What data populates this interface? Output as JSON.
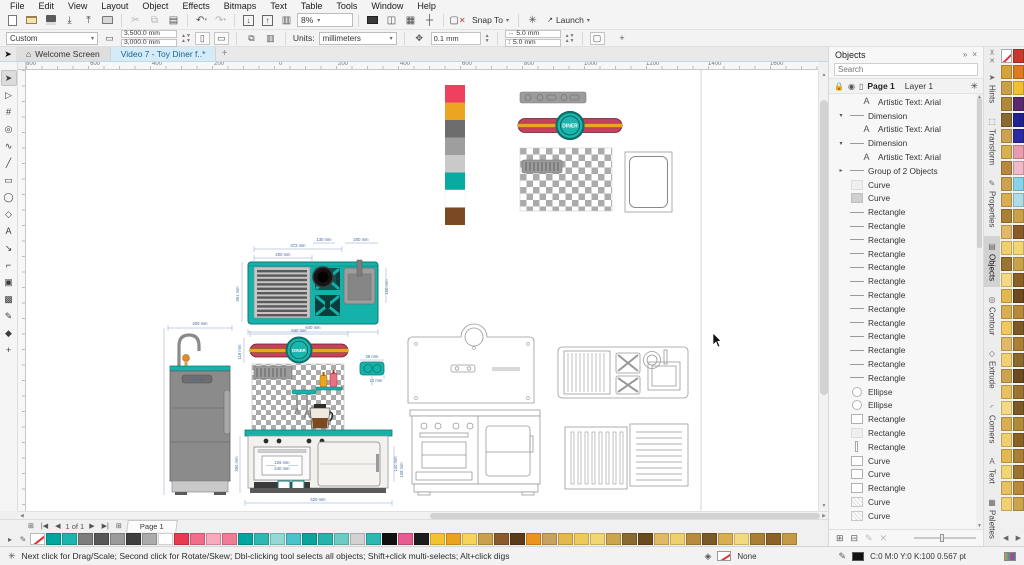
{
  "menu_items": [
    "File",
    "Edit",
    "View",
    "Layout",
    "Object",
    "Effects",
    "Bitmaps",
    "Text",
    "Table",
    "Tools",
    "Window",
    "Help"
  ],
  "toolbar": {
    "zoom": "8%",
    "snap": "Snap To",
    "launch": "Launch"
  },
  "property_bar": {
    "preset": "Custom",
    "width": "3,500.0 mm",
    "height": "3,000.0 mm",
    "units_label": "Units:",
    "units": "millimeters",
    "nudge": "0.1 mm",
    "dup_x": "5.0 mm",
    "dup_y": "5.0 mm"
  },
  "doc_tabs": {
    "welcome": "Welcome Screen",
    "active": "Video 7 - Toy Diner f..*"
  },
  "ruler_numbers": [
    "800",
    "600",
    "400",
    "200",
    "0",
    "200",
    "400",
    "600",
    "800",
    "1000",
    "1200",
    "1400",
    "1600"
  ],
  "toolbox": [
    {
      "g": "➤",
      "cls": "active",
      "name": "pick-tool"
    },
    {
      "g": "▷",
      "cls": "",
      "name": "shape-tool"
    },
    {
      "g": "#",
      "cls": "",
      "name": "crop-tool"
    },
    {
      "g": "◎",
      "cls": "",
      "name": "zoom-tool"
    },
    {
      "g": "∿",
      "cls": "",
      "name": "freehand-tool"
    },
    {
      "g": "╱",
      "cls": "",
      "name": "two-point-line-tool"
    },
    {
      "g": "▭",
      "cls": "",
      "name": "rectangle-tool"
    },
    {
      "g": "◯",
      "cls": "",
      "name": "ellipse-tool"
    },
    {
      "g": "◇",
      "cls": "",
      "name": "polygon-tool"
    },
    {
      "g": "A",
      "cls": "",
      "name": "text-tool"
    },
    {
      "g": "↘",
      "cls": "",
      "name": "dimension-tool"
    },
    {
      "g": "⌐",
      "cls": "",
      "name": "connector-tool"
    },
    {
      "g": "▣",
      "cls": "",
      "name": "drop-shadow-tool"
    },
    {
      "g": "▩",
      "cls": "",
      "name": "transparency-tool"
    },
    {
      "g": "✎",
      "cls": "",
      "name": "eyedropper-tool"
    },
    {
      "g": "◆",
      "cls": "",
      "name": "interactive-fill-tool"
    },
    {
      "g": "+",
      "cls": "",
      "name": "more-tools-button"
    }
  ],
  "objects": {
    "title": "Objects",
    "search_placeholder": "Search",
    "page": "Page 1",
    "layer": "Layer 1",
    "items": [
      {
        "e": "",
        "t": "t-a",
        "cls": "ind1",
        "label": "Artistic Text: Arial"
      },
      {
        "e": "▾",
        "t": "t-line",
        "cls": "",
        "label": "Dimension"
      },
      {
        "e": "",
        "t": "t-a",
        "cls": "ind1",
        "label": "Artistic Text: Arial"
      },
      {
        "e": "▾",
        "t": "t-line",
        "cls": "",
        "label": "Dimension"
      },
      {
        "e": "",
        "t": "t-a",
        "cls": "ind1",
        "label": "Artistic Text: Arial"
      },
      {
        "e": "▸",
        "t": "t-line",
        "cls": "",
        "label": "Group of 2 Objects"
      },
      {
        "e": "",
        "t": "t-sqlight",
        "cls": "",
        "label": "Curve"
      },
      {
        "e": "",
        "t": "t-sqgray",
        "cls": "",
        "label": "Curve"
      },
      {
        "e": "",
        "t": "t-line",
        "cls": "",
        "label": "Rectangle"
      },
      {
        "e": "",
        "t": "t-line",
        "cls": "",
        "label": "Rectangle"
      },
      {
        "e": "",
        "t": "t-line",
        "cls": "",
        "label": "Rectangle"
      },
      {
        "e": "",
        "t": "t-line",
        "cls": "",
        "label": "Rectangle"
      },
      {
        "e": "",
        "t": "t-line",
        "cls": "",
        "label": "Rectangle"
      },
      {
        "e": "",
        "t": "t-line",
        "cls": "",
        "label": "Rectangle"
      },
      {
        "e": "",
        "t": "t-line",
        "cls": "",
        "label": "Rectangle"
      },
      {
        "e": "",
        "t": "t-line",
        "cls": "",
        "label": "Rectangle"
      },
      {
        "e": "",
        "t": "t-line",
        "cls": "",
        "label": "Rectangle"
      },
      {
        "e": "",
        "t": "t-line",
        "cls": "",
        "label": "Rectangle"
      },
      {
        "e": "",
        "t": "t-line",
        "cls": "",
        "label": "Rectangle"
      },
      {
        "e": "",
        "t": "t-line",
        "cls": "",
        "label": "Rectangle"
      },
      {
        "e": "",
        "t": "t-line",
        "cls": "",
        "label": "Rectangle"
      },
      {
        "e": "",
        "t": "t-circle",
        "cls": "",
        "label": "Ellipse"
      },
      {
        "e": "",
        "t": "t-circle",
        "cls": "",
        "label": "Ellipse"
      },
      {
        "e": "",
        "t": "t-sqoutline",
        "cls": "",
        "label": "Rectangle"
      },
      {
        "e": "",
        "t": "t-sqlight",
        "cls": "",
        "label": "Rectangle"
      },
      {
        "e": "",
        "t": "t-vline",
        "cls": "",
        "label": "Rectangle"
      },
      {
        "e": "",
        "t": "t-sqoutline",
        "cls": "",
        "label": "Curve"
      },
      {
        "e": "",
        "t": "t-sqoutline",
        "cls": "",
        "label": "Curve"
      },
      {
        "e": "",
        "t": "t-sqoutline",
        "cls": "",
        "label": "Rectangle"
      },
      {
        "e": "",
        "t": "t-hatch",
        "cls": "",
        "label": "Curve"
      },
      {
        "e": "",
        "t": "t-hatch",
        "cls": "",
        "label": "Curve"
      }
    ]
  },
  "docker_tabs": [
    {
      "label": "Hints",
      "ico": "➤",
      "cls": "",
      "name": "docker-tab-hints"
    },
    {
      "label": "Transform",
      "ico": "⬚",
      "cls": "",
      "name": "docker-tab-transform"
    },
    {
      "label": "Properties",
      "ico": "✎",
      "cls": "",
      "name": "docker-tab-properties"
    },
    {
      "label": "Objects",
      "ico": "▤",
      "cls": "active",
      "name": "docker-tab-objects"
    },
    {
      "label": "Contour",
      "ico": "◎",
      "cls": "",
      "name": "docker-tab-contour"
    },
    {
      "label": "Extrude",
      "ico": "◇",
      "cls": "",
      "name": "docker-tab-extrude"
    },
    {
      "label": "Corners",
      "ico": "◜",
      "cls": "",
      "name": "docker-tab-corners"
    },
    {
      "label": "Text",
      "ico": "A",
      "cls": "",
      "name": "docker-tab-text"
    },
    {
      "label": "Palettes",
      "ico": "▦",
      "cls": "",
      "name": "docker-tab-palettes"
    }
  ],
  "page_nav": {
    "counter": "1 of 1",
    "tab": "Page 1"
  },
  "status": {
    "hint": "Next click for Drag/Scale; Second click for Rotate/Skew; Dbl-clicking tool selects all objects; Shift+click multi-selects; Alt+click digs",
    "fill_label": "None",
    "outline": "C:0 M:0 Y:0 K:100  0.567 pt"
  },
  "palette_bottom": [
    "#00a5a0",
    "#1cb5ad",
    "#7d7d7d",
    "#585858",
    "#9a9a9a",
    "#3f3f3f",
    "#ababab",
    "#ffffff",
    "#e83a52",
    "#f06e8a",
    "#f6aabb",
    "#ef7d97",
    "#00a5a0",
    "#2fb8b1",
    "#93d8d4",
    "#49c2cb",
    "#0ba39c",
    "#25b3ab",
    "#6ecac5",
    "#d2d2d2",
    "#2fb8b1",
    "#101010",
    "#e85c92",
    "#1c1c1c",
    "#f2c230",
    "#eaa31e",
    "#f6d45c",
    "#c9a04b",
    "#8a5a2b",
    "#5c3b1b",
    "#ea941e",
    "#c9a15f",
    "#e2b84f",
    "#eeca5d",
    "#f2d674",
    "#caa44e",
    "#8a6a2e",
    "#6a4a1e",
    "#e0b964",
    "#f0cf6e",
    "#b98a3e",
    "#7a5a26",
    "#d9ae52",
    "#f4d983",
    "#a97f35",
    "#8a6228",
    "#c49a44"
  ],
  "palette_right": [
    "#c8372e",
    "#d4a43a",
    "#e07b22",
    "#caa04b",
    "#f0c030",
    "#b08a3a",
    "#5a2a6e",
    "#8a6a2e",
    "#22228e",
    "#caa44e",
    "#2a2aa0",
    "#d4b050",
    "#e89ab0",
    "#b98a3e",
    "#f0b8c8",
    "#caa44e",
    "#8ad2e8",
    "#d9ae52",
    "#b0dce8",
    "#a97f35",
    "#caa04b",
    "#e0b964",
    "#8a5a2b",
    "#f0cf6e",
    "#f2d674",
    "#9a7430",
    "#c9a04b",
    "#f4d983",
    "#8a6228",
    "#e2b84f",
    "#6a4a1e",
    "#d9ae52",
    "#b98a3e",
    "#f2c85e",
    "#7a5a26",
    "#e0b964",
    "#a97f35",
    "#f0d070",
    "#8a6a2e",
    "#caa44e",
    "#6a4a1e",
    "#e8c060",
    "#9a7430",
    "#f4d983",
    "#7a5a26",
    "#d9ae52",
    "#b08a3a",
    "#f0cf6e",
    "#8a6228",
    "#e2b84f",
    "#a97f35",
    "#f2d674",
    "#9a7430",
    "#e8c060",
    "#b98a3e",
    "#f0d070",
    "#caa44e"
  ],
  "artwork": {
    "diner": "DINER",
    "dims": {
      "d372": "372 mm",
      "d200a": "200 mm",
      "d130": "130 mm",
      "d200b": "200 mm",
      "d361": "361 mm",
      "d140": "140 mm",
      "d160": "160 mm",
      "d640": "640 mm",
      "d640b": "640 mm",
      "d119": "119 mm",
      "d226": "226 mm",
      "d240": "240 mm",
      "d140b": "140 mm",
      "d108": "108 mm",
      "d620": "620 mm",
      "d350": "350 mm",
      "d400": "400 mm",
      "d148": "148 mm",
      "d28": "28 mm",
      "d12": "12 mm"
    }
  }
}
